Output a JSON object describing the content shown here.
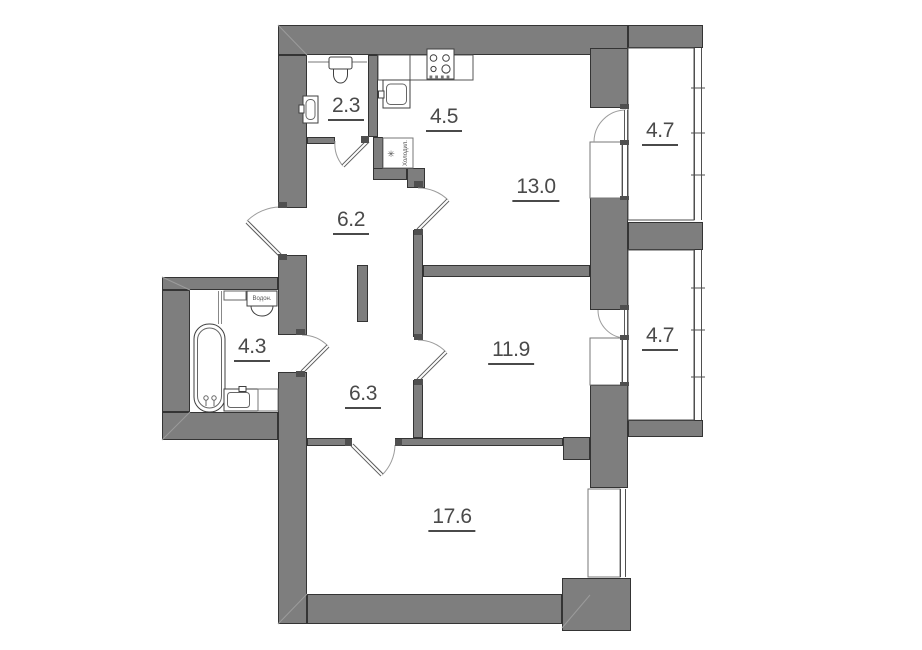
{
  "plan": {
    "rooms": [
      {
        "name": "wc",
        "area": "2.3"
      },
      {
        "name": "kitchen",
        "area": "4.5"
      },
      {
        "name": "living-room",
        "area": "13.0"
      },
      {
        "name": "balcony-top",
        "area": "4.7"
      },
      {
        "name": "hallway",
        "area": "6.2"
      },
      {
        "name": "bathroom",
        "area": "4.3"
      },
      {
        "name": "corridor",
        "area": "6.3"
      },
      {
        "name": "bedroom",
        "area": "11.9"
      },
      {
        "name": "balcony-right",
        "area": "4.7"
      },
      {
        "name": "bedroom-large",
        "area": "17.6"
      }
    ],
    "fixtures": {
      "water_heater_label": "Водон.",
      "fridge_label": "Холодил.",
      "fridge_symbol": "✳"
    },
    "colors": {
      "wall_fill": "#7e7e7e",
      "wall_outline": "#343434",
      "label_text": "#4a4a4a",
      "door_arc": "#9c9c9c"
    }
  }
}
